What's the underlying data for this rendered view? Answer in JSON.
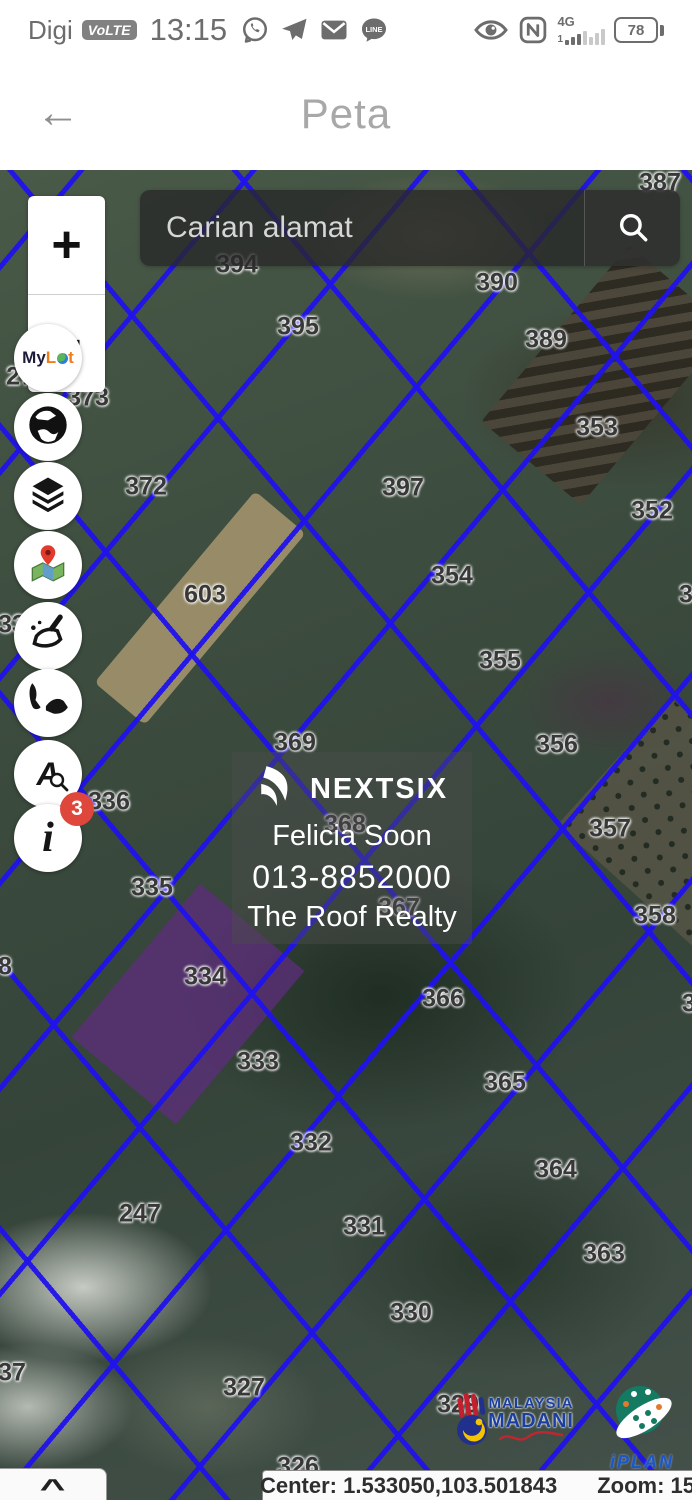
{
  "status_bar": {
    "carrier": "Digi",
    "volte": "VoLTE",
    "time": "13:15",
    "nfc": "N",
    "network": "4G",
    "sim_number": "1",
    "line_label": "LINE",
    "battery_percent": "78"
  },
  "title_bar": {
    "back": "←",
    "title": "Peta"
  },
  "search": {
    "placeholder": "Carian alamat"
  },
  "zoom_control": {
    "zoom_in": "+",
    "zoom_out": "−"
  },
  "sidebar": {
    "mylot_part1": "My",
    "mylot_part2": "L",
    "mylot_part3": "t",
    "lot_search_letter": "A",
    "info_glyph": "i",
    "info_badge": "3"
  },
  "watermark": {
    "brand": "NEXTSIX",
    "agent": "Felicia Soon",
    "phone": "013-8852000",
    "agency": "The Roof Realty"
  },
  "logos": {
    "madani_top": "MALAYSIA",
    "madani_bottom": "MADANI",
    "iplan": "iPLAN"
  },
  "footer": {
    "collapse": "^",
    "center": "Center: 1.533050,103.501843",
    "zoom": "Zoom: 15"
  },
  "map": {
    "lots": [
      {
        "label": "387",
        "x": 660,
        "y": 13
      },
      {
        "label": "394",
        "x": 237,
        "y": 95
      },
      {
        "label": "390",
        "x": 497,
        "y": 113
      },
      {
        "label": "395",
        "x": 298,
        "y": 157
      },
      {
        "label": "389",
        "x": 546,
        "y": 170
      },
      {
        "label": "270",
        "x": 27,
        "y": 207
      },
      {
        "label": "373",
        "x": 88,
        "y": 228
      },
      {
        "label": "353",
        "x": 597,
        "y": 258
      },
      {
        "label": "372",
        "x": 146,
        "y": 317
      },
      {
        "label": "397",
        "x": 403,
        "y": 318
      },
      {
        "label": "352",
        "x": 652,
        "y": 341
      },
      {
        "label": "354",
        "x": 452,
        "y": 406
      },
      {
        "label": "603",
        "x": 205,
        "y": 425
      },
      {
        "label": "3",
        "x": 686,
        "y": 425
      },
      {
        "label": "33",
        "x": 12,
        "y": 455
      },
      {
        "label": "355",
        "x": 500,
        "y": 491
      },
      {
        "label": "369",
        "x": 295,
        "y": 573
      },
      {
        "label": "356",
        "x": 557,
        "y": 575
      },
      {
        "label": "336",
        "x": 109,
        "y": 632
      },
      {
        "label": "368",
        "x": 345,
        "y": 655
      },
      {
        "label": "357",
        "x": 610,
        "y": 659
      },
      {
        "label": "335",
        "x": 152,
        "y": 718
      },
      {
        "label": "367",
        "x": 399,
        "y": 738
      },
      {
        "label": "358",
        "x": 655,
        "y": 746
      },
      {
        "label": "8",
        "x": 5,
        "y": 797
      },
      {
        "label": "334",
        "x": 205,
        "y": 807
      },
      {
        "label": "366",
        "x": 443,
        "y": 829
      },
      {
        "label": "3",
        "x": 689,
        "y": 834
      },
      {
        "label": "333",
        "x": 258,
        "y": 892
      },
      {
        "label": "365",
        "x": 505,
        "y": 913
      },
      {
        "label": "332",
        "x": 311,
        "y": 973
      },
      {
        "label": "364",
        "x": 556,
        "y": 1000
      },
      {
        "label": "247",
        "x": 140,
        "y": 1044
      },
      {
        "label": "331",
        "x": 364,
        "y": 1057
      },
      {
        "label": "363",
        "x": 604,
        "y": 1084
      },
      {
        "label": "330",
        "x": 411,
        "y": 1143
      },
      {
        "label": "37",
        "x": 12,
        "y": 1203
      },
      {
        "label": "327",
        "x": 244,
        "y": 1218
      },
      {
        "label": "329",
        "x": 458,
        "y": 1235
      },
      {
        "label": "326",
        "x": 298,
        "y": 1297
      }
    ]
  },
  "colors": {
    "boundary_blue": "#2012ec",
    "purple_lot": "#5f2d80",
    "badge_red": "#e0473c",
    "accent_orange": "#ef7d1a"
  }
}
